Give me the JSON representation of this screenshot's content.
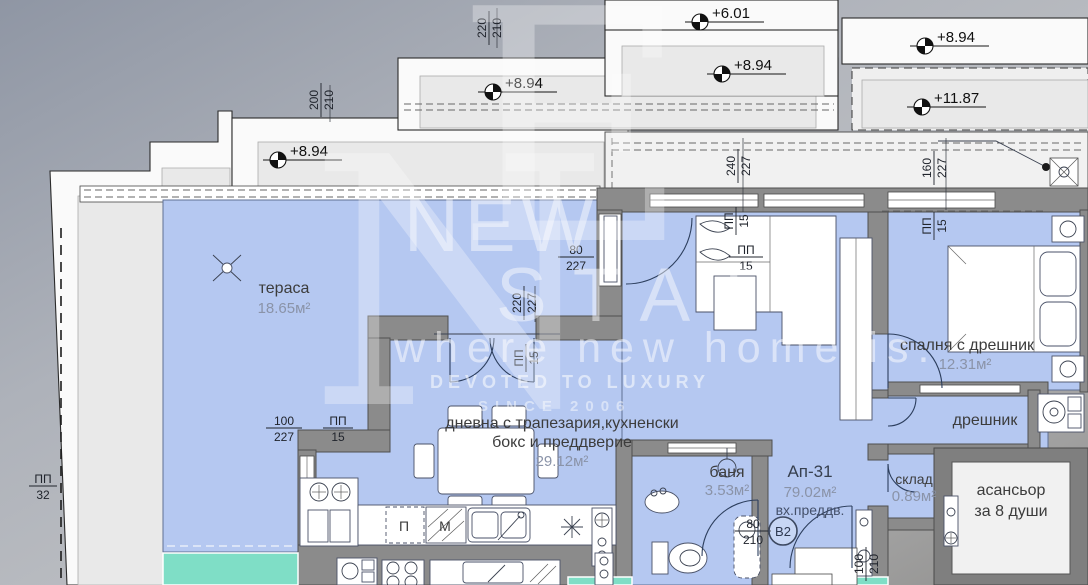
{
  "watermark": {
    "letter1": "N",
    "letter2": "E",
    "word1": "NEW",
    "word2": "STATE",
    "tagline": "where new home is.",
    "motto": "DEVOTED TO LUXURY",
    "since": "SINCE 2006"
  },
  "elevations": {
    "e1": "+6.01",
    "e2": "+8.94",
    "e3": "+8.94",
    "e4": "+11.87",
    "e5": "+8.94",
    "e6": "+8.94"
  },
  "rooms": {
    "terrace": {
      "name": "тераса",
      "area": "18.65м²"
    },
    "living": {
      "name1": "дневна с трапезария,кухненски",
      "name2": "бокс и преддверие",
      "area": "29.12м²"
    },
    "bedroom": {
      "name": "спалня с дрешник",
      "area": "12.31м²"
    },
    "bath": {
      "name": "баня",
      "area": "3.53м²"
    },
    "apt": {
      "name": "Ап-31",
      "area": "79.02м²",
      "sub": "вх.преддв."
    },
    "storage": {
      "name": "склад",
      "area": "0.89м²"
    },
    "closet": {
      "name": "дрешник"
    },
    "elevator": {
      "name1": "асансьор",
      "name2": "за 8 души"
    }
  },
  "dims": {
    "d220_210": {
      "a": "220",
      "b": "210"
    },
    "d200_210": {
      "a": "200",
      "b": "210"
    },
    "d80_227": {
      "a": "80",
      "b": "227"
    },
    "d220_227": {
      "a": "220",
      "b": "227"
    },
    "d240_227": {
      "a": "240",
      "b": "227"
    },
    "d160_227": {
      "a": "160",
      "b": "227"
    },
    "d100_227": {
      "a": "100",
      "b": "227"
    },
    "d80_210": {
      "a": "80",
      "b": "210"
    },
    "d100_210": {
      "a": "100",
      "b": "210"
    },
    "pp15": {
      "a": "ПП",
      "b": "15"
    },
    "pp32": {
      "a": "ПП",
      "b": "32"
    }
  },
  "badges": {
    "unit": "B2"
  },
  "appliances": {
    "dishwasher": "П",
    "washer": "М"
  },
  "colors": {
    "room_fill": "#b5c8f1",
    "terrace_teal": "#7fdec6",
    "wall": "#8b8b8b",
    "panel": "#e9e9e9",
    "background": "#a7abb4"
  }
}
